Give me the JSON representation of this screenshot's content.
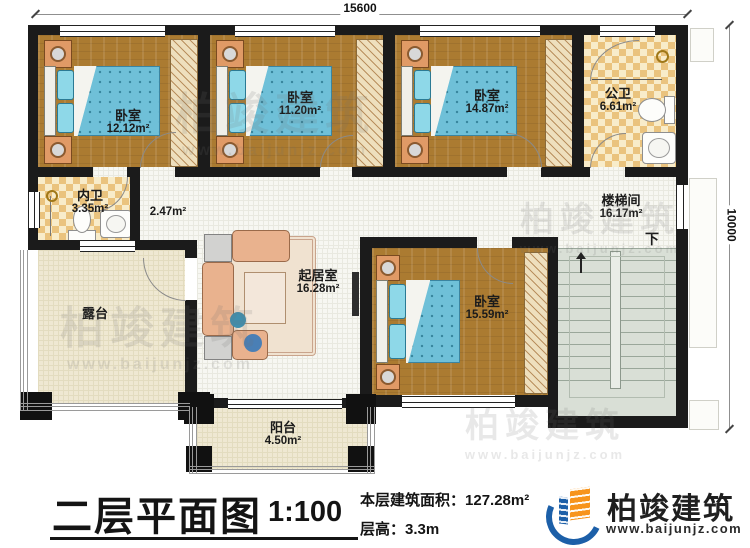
{
  "dimensions": {
    "width_mm": "15600",
    "height_mm": "10000"
  },
  "rooms": {
    "bedroom1": {
      "name": "卧室",
      "area": "12.12m²"
    },
    "bedroom2": {
      "name": "卧室",
      "area": "11.20m²"
    },
    "bedroom3": {
      "name": "卧室",
      "area": "14.87m²"
    },
    "bedroom4": {
      "name": "卧室",
      "area": "15.59m²"
    },
    "public_bath": {
      "name": "公卫",
      "area": "6.61m²"
    },
    "inner_bath": {
      "name": "内卫",
      "area": "3.35m²"
    },
    "hall": {
      "area": "2.47m²"
    },
    "stairwell": {
      "name": "楼梯间",
      "area": "16.17m²",
      "down_label": "下"
    },
    "living_room": {
      "name": "起居室",
      "area": "16.28m²"
    },
    "terrace": {
      "name": "露台"
    },
    "balcony": {
      "name": "阳台",
      "area": "4.50m²"
    }
  },
  "title_block": {
    "title": "二层平面图",
    "scale": "1:100",
    "area_label": "本层建筑面积：",
    "area_value": "127.28m²",
    "floor_height_label": "层高：",
    "floor_height_value": "3.3m"
  },
  "logo": {
    "name": "柏竣建筑",
    "url": "www.baijunjz.com"
  },
  "watermark": {
    "name": "柏竣建筑",
    "url": "www.baijunjz.com"
  },
  "colors": {
    "wall": "#1b1b1b",
    "wood_floor": "#ab7b31",
    "bed_blue": "#6fc0d8",
    "bath_tile": "#eac37e",
    "outdoor_floor": "#efe8d2",
    "stairs": "#d9dfd6",
    "logo_blue": "#1c5fa8",
    "logo_orange": "#f7941d"
  }
}
